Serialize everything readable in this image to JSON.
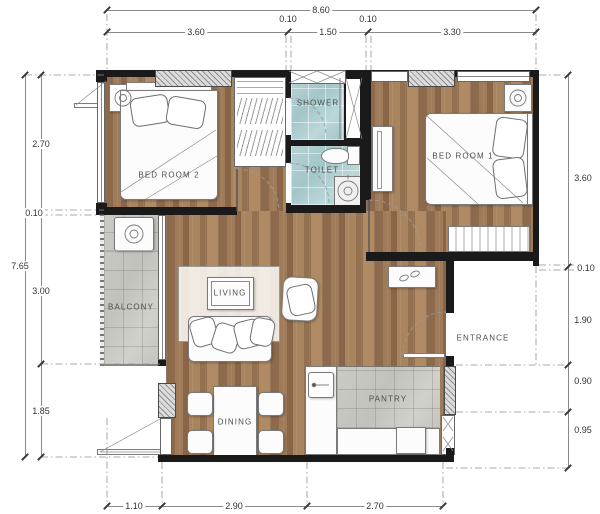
{
  "labels": {
    "bedroom2": "BED ROOM 2",
    "bedroom1": "BED ROOM 1",
    "shower": "SHOWER",
    "toilet": "TOILET",
    "balcony": "BALCONY",
    "living": "LIVING",
    "dining": "DINING",
    "pantry": "PANTRY",
    "entrance": "ENTRANCE"
  },
  "dims": {
    "top_overall": "8.60",
    "top": [
      "3.60",
      "0.10",
      "1.50",
      "0.10",
      "3.30"
    ],
    "left_overall": "7.65",
    "left": [
      "2.70",
      "0.10",
      "3.00",
      "1.85"
    ],
    "right": [
      "3.60",
      "0.10",
      "1.90",
      "0.90",
      "0.95"
    ],
    "bottom": [
      "1.10",
      "2.90",
      "2.70"
    ]
  },
  "colors": {
    "wall": "#1a1a1a",
    "wood_floor": "#9b7758",
    "bath_tile": "#aecdd0",
    "gray_tile": "#c6c6c0",
    "dimension_text": "#333333"
  }
}
